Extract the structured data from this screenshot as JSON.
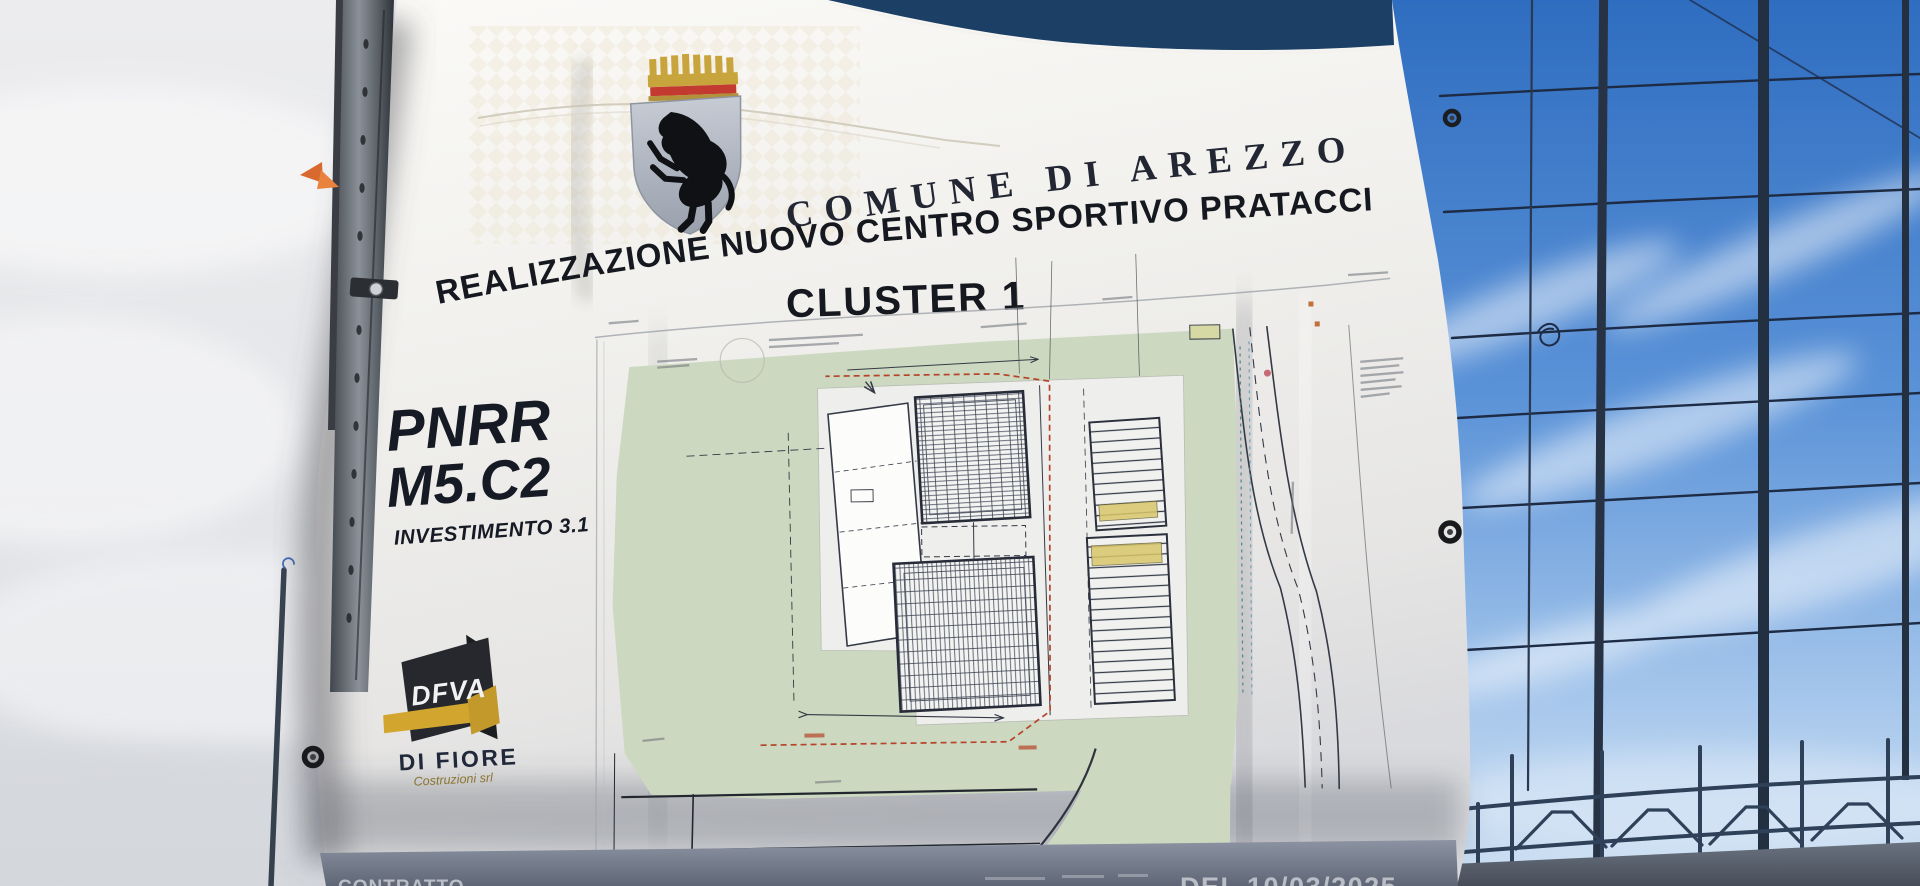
{
  "banner": {
    "municipality": "COMUNE DI AREZZO",
    "project_title": "REALIZZAZIONE NUOVO CENTRO SPORTIVO PRATACCI",
    "project_subtitle": "CLUSTER 1",
    "funding": {
      "program": "PNRR",
      "mission": "M5.C2",
      "investment": "INVESTIMENTO 3.1"
    },
    "contractor": {
      "logo": "DFVA",
      "name": "DI FIORE",
      "subtitle": "Costruzioni srl"
    },
    "footer": {
      "left": "CONTRATTO",
      "right": "DEL 10/03/2025"
    }
  },
  "colors": {
    "banner_blue": "#1c3f66",
    "crest_red": "#c23a30",
    "crest_gold": "#c8a43c",
    "logo_gold": "#d2a62e",
    "plan_green": "#ccd9c0",
    "plan_red_dash": "#b5442a",
    "sky_blue": "#4c86cc"
  }
}
